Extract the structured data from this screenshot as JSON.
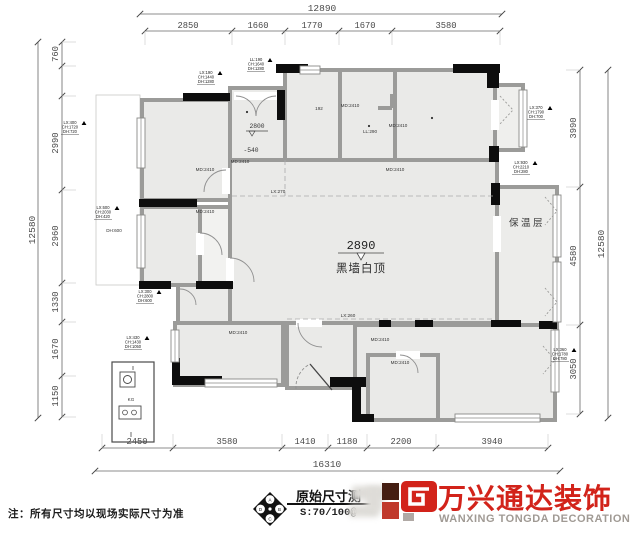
{
  "page": {
    "note": "注：所有尺寸均以现场实际尺寸为准"
  },
  "title_block": {
    "drawing_title": "原始尺寸测",
    "scale_text": "S:70/100@",
    "brand_cn": "万兴通达装饰",
    "brand_en": "WANXING TONGDA DECORATION",
    "compass_letters": [
      "A",
      "B",
      "C",
      "D"
    ]
  },
  "colors": {
    "brand_red": "#d2231a",
    "brand_gray": "#a09a94",
    "wall_gray": "#9b9b99",
    "room_fill": "#eaeae8",
    "black_wall": "#0d0d0d"
  },
  "dimensions": {
    "top": {
      "overall": "12890",
      "segments": [
        "2850",
        "1660",
        "1770",
        "1670",
        "3580"
      ]
    },
    "bottom": {
      "overall": "16310",
      "segments": [
        "2450",
        "3580",
        "1410",
        "1180",
        "2200",
        "3940"
      ]
    },
    "left": {
      "overall": "12580",
      "segments": [
        "760",
        "2990",
        "2960",
        "1330",
        "1670",
        "1150"
      ]
    },
    "right": {
      "overall": "12580",
      "segments": [
        "3990",
        "4580",
        "3050"
      ]
    }
  },
  "plan": {
    "room_note": {
      "value": "2890",
      "label": "黑墙白顶"
    },
    "entry_levels": {
      "upper": "2800",
      "lower": "-540"
    },
    "insulation_label": "保温层",
    "panel_label": "KG",
    "labels": [
      {
        "t": "MD:2410",
        "x": 205,
        "y": 171,
        "cls": "t-md"
      },
      {
        "t": "MD:2410",
        "x": 240,
        "y": 163,
        "cls": "t-md"
      },
      {
        "t": "MD:2410",
        "x": 350,
        "y": 107,
        "cls": "t-md"
      },
      {
        "t": "MD:2410",
        "x": 398,
        "y": 127,
        "cls": "t-md"
      },
      {
        "t": "MD:2410",
        "x": 395,
        "y": 171,
        "cls": "t-md"
      },
      {
        "t": "LL:290",
        "x": 370,
        "y": 133,
        "cls": "t-md"
      },
      {
        "t": "MD:2410",
        "x": 205,
        "y": 213,
        "cls": "t-md"
      },
      {
        "t": "MD:2410",
        "x": 238,
        "y": 334,
        "cls": "t-md"
      },
      {
        "t": "MD:2410",
        "x": 380,
        "y": 341,
        "cls": "t-md"
      },
      {
        "t": "MD:2410",
        "x": 400,
        "y": 364,
        "cls": "t-md"
      },
      {
        "t": "192",
        "x": 319,
        "y": 110,
        "cls": "t-md"
      },
      {
        "t": "DH:600",
        "x": 114,
        "y": 232,
        "cls": "t-md"
      },
      {
        "t": "LX:270",
        "x": 278,
        "y": 193,
        "cls": "t-md"
      },
      {
        "t": "LX:260",
        "x": 348,
        "y": 317,
        "cls": "t-md"
      }
    ],
    "stacks": [
      {
        "x": 70,
        "y": 124,
        "lines": [
          "LX:400",
          "CH:1720",
          "DH:720"
        ]
      },
      {
        "x": 103,
        "y": 209,
        "lines": [
          "LX:600",
          "CH:2030",
          "DH:420"
        ]
      },
      {
        "x": 145,
        "y": 293,
        "lines": [
          "LX:300",
          "CH:2800",
          "DH:600"
        ]
      },
      {
        "x": 133,
        "y": 339,
        "lines": [
          "LX:430",
          "CH:1430",
          "DH:1050"
        ]
      },
      {
        "x": 206,
        "y": 74,
        "lines": [
          "LX:190",
          "CH:1440",
          "DH:1280"
        ]
      },
      {
        "x": 256,
        "y": 61,
        "lines": [
          "LL:190",
          "CH:1640",
          "DH:1280"
        ]
      },
      {
        "x": 536,
        "y": 109,
        "lines": [
          "LX:370",
          "CH:1790",
          "DH:700"
        ]
      },
      {
        "x": 521,
        "y": 164,
        "lines": [
          "LX:930",
          "CH:2210",
          "DH:280"
        ]
      },
      {
        "x": 560,
        "y": 351,
        "lines": [
          "LX:360",
          "CH:1780",
          "DH:780"
        ]
      }
    ]
  }
}
